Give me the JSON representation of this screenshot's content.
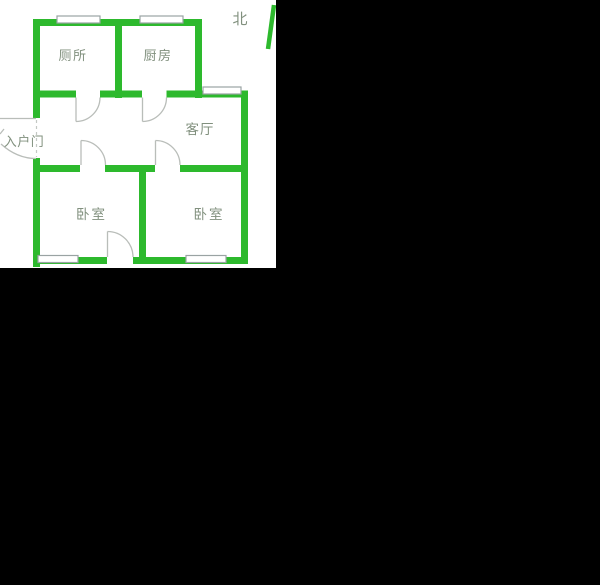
{
  "page": {
    "background": "#000000",
    "plan_background": "#ffffff"
  },
  "floorplan": {
    "labels": {
      "toilet": "厕所",
      "kitchen": "厨房",
      "living_room": "客厅",
      "entrance": "入户门",
      "bedroom_left": "卧室",
      "bedroom_right": "卧室",
      "north": "北"
    },
    "colors": {
      "wall": "#2db92d",
      "label": "#81907e",
      "window_stroke": "#9aa3a3",
      "door_stroke": "#b9bdb9",
      "dash_stroke": "#c4c8c4"
    }
  }
}
